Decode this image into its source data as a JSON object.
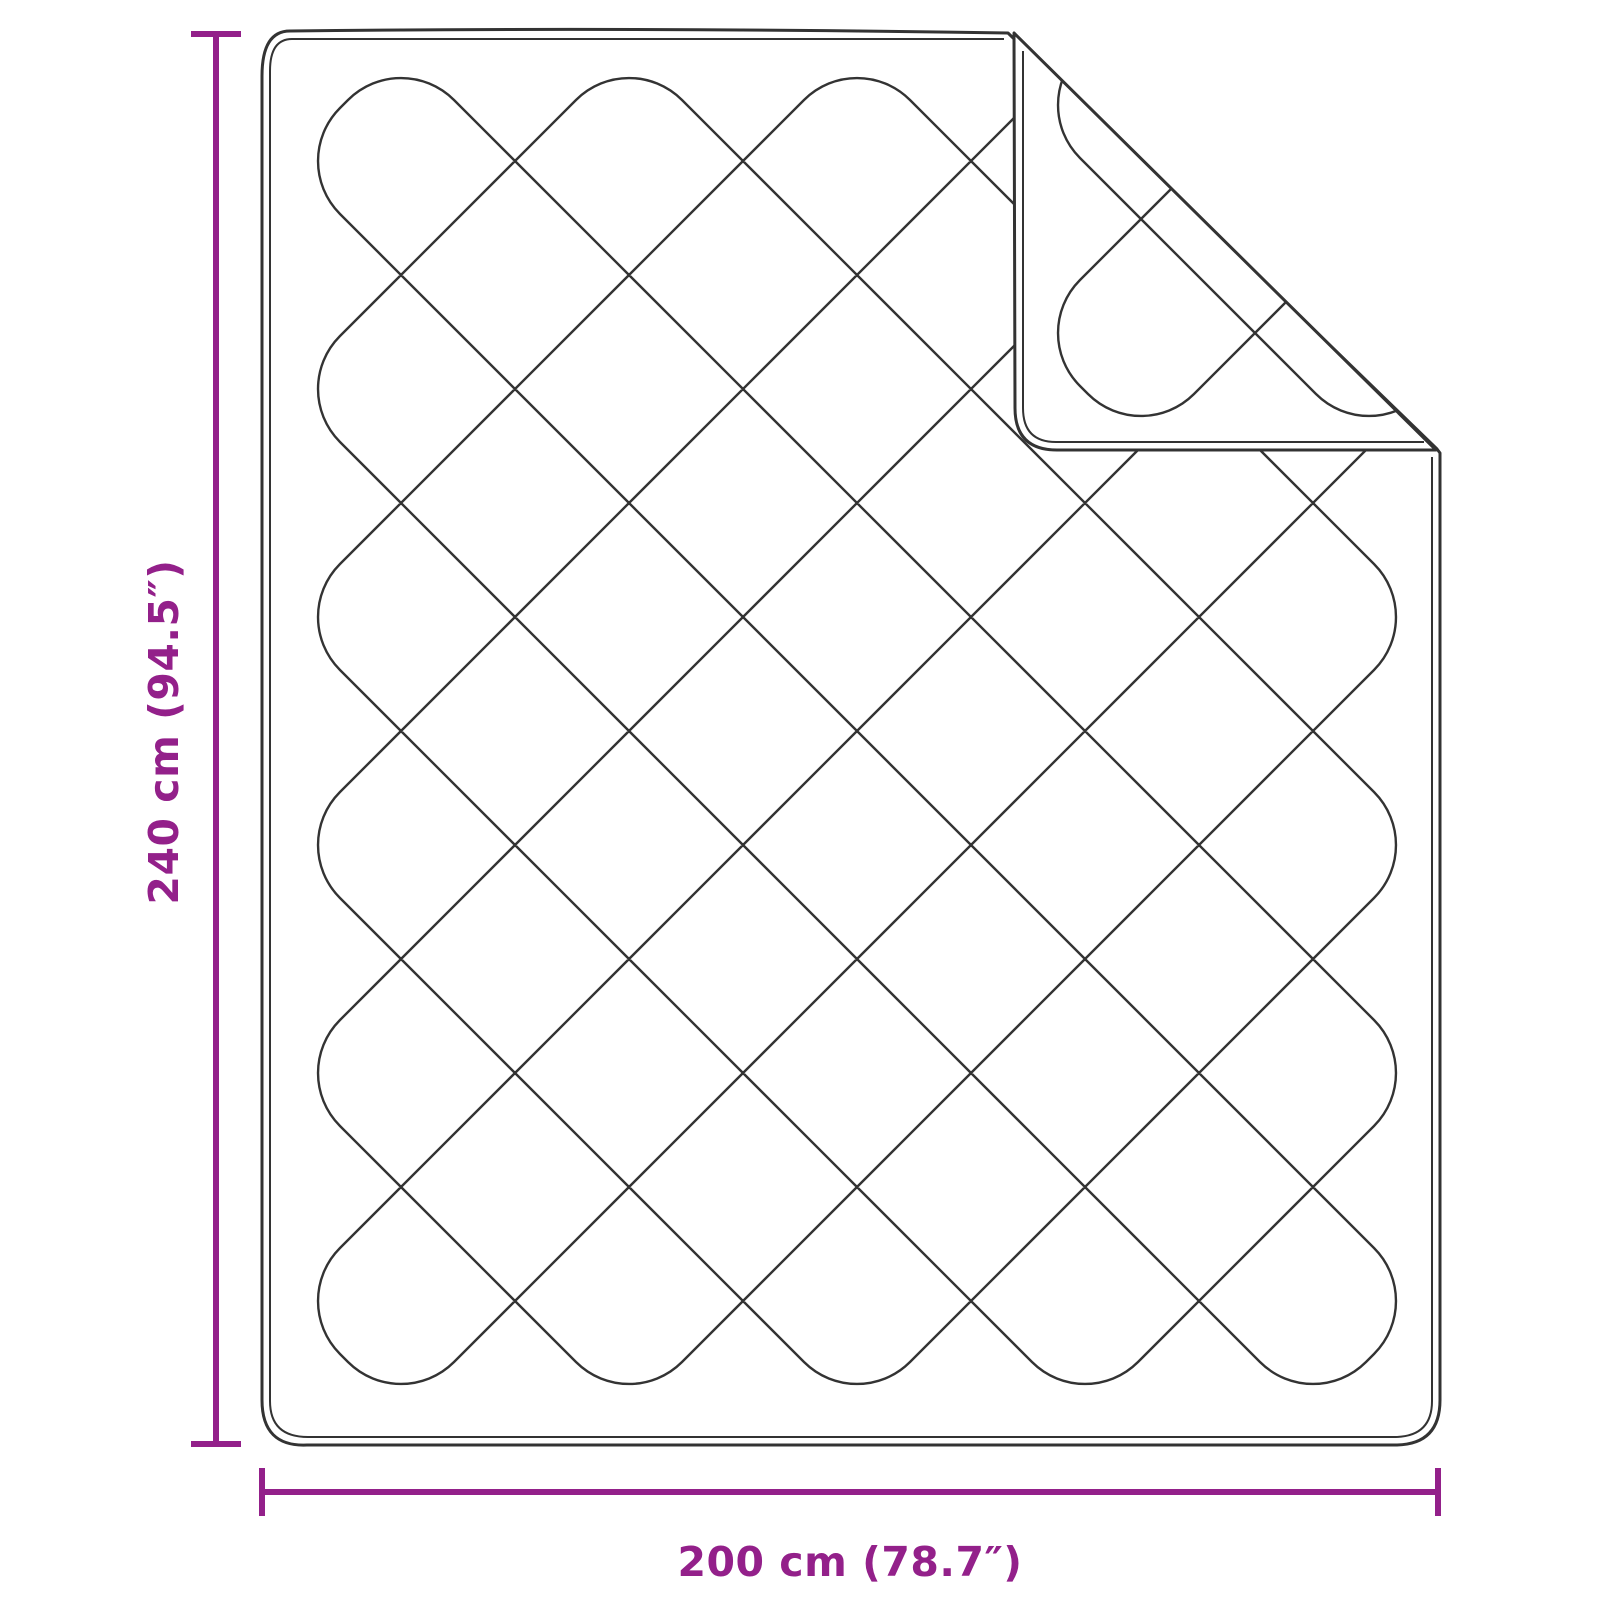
{
  "diagram": {
    "kind": "product-dimension-diagram",
    "subject": "quilted-blanket-with-folded-corner",
    "height_label": "240 cm (94.5″)",
    "width_label": "200 cm (78.7″)"
  },
  "colors": {
    "accent": "#93208a",
    "ink": "#333333",
    "background": "#ffffff"
  },
  "drawing": {
    "canvas": {
      "w": 1600,
      "h": 1600
    },
    "body": {
      "left": 262,
      "top": 31,
      "right": 1440,
      "bottom": 1445,
      "cornerR": 45,
      "inset": 8,
      "foldTopX": 1008,
      "tipX": 1437,
      "tipY": 449
    },
    "flap": {
      "legX": 1014,
      "topY": 33,
      "botY": 450,
      "tipX": 1436,
      "cornerR": 42,
      "inset": 8
    },
    "quilt": {
      "period": 228,
      "turnR": 75,
      "bodyAOffset": 126,
      "bodyBOffset": 448,
      "flapAOffset": 10,
      "bodyRegion": {
        "x0": 270,
        "y0": 39,
        "x1": 1432,
        "y1": 1437
      },
      "flapRegion": {
        "x0": 1021,
        "y0": 40,
        "x1": 1437,
        "y1": 440
      },
      "margin": 70
    },
    "strokes": {
      "outline": 3,
      "inner": 2,
      "pattern": 2.4
    },
    "dims": {
      "v": {
        "x": 216,
        "yTop": 31,
        "yBot": 1447,
        "capHalf": 25,
        "thick": 6,
        "labelX": 164,
        "labelY": 732
      },
      "h": {
        "y": 1492,
        "xLeft": 259,
        "xRight": 1441,
        "capHalf": 24,
        "thick": 6,
        "labelX": 850,
        "labelY": 1562
      }
    }
  }
}
